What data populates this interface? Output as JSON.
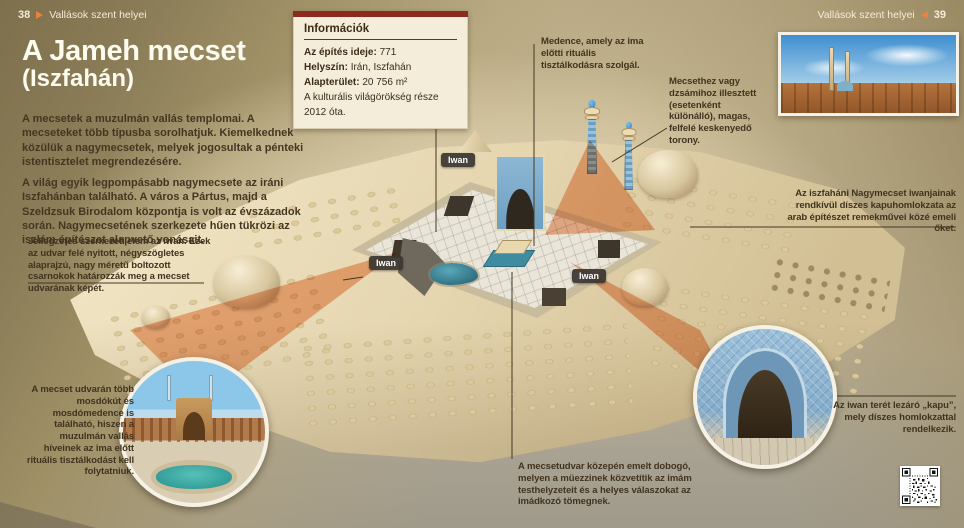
{
  "page": {
    "header_left": {
      "page_number": "38",
      "section": "Vallások szent helyei"
    },
    "header_right": {
      "page_number": "39",
      "section": "Vallások szent helyei"
    },
    "title": "A Jameh mecset",
    "subtitle": "(Iszfahán)",
    "intro_paragraphs": [
      "A mecsetek a muzulmán vallás templomai. A mecseteket több típusba sorolhatjuk. Kiemelkednek közülük a nagymecsetek, melyek jogosultak a pénteki istentisztelet megrendezésére.",
      "A világ egyik legpompásabb nagymecsete az iráni Iszfahánban található. A város a Pártus, majd a Szeldzsuk Birodalom központja is volt az évszázadok során. Nagymecsetének szerkezete hűen tükrözi az iszlám építészet alapvető vonásait."
    ]
  },
  "info_box": {
    "title": "Információk",
    "rows": [
      {
        "label": "Az építés ideje:",
        "value": "771"
      },
      {
        "label": "Helyszín:",
        "value": "Irán, Iszfahán"
      },
      {
        "label": "Alapterület:",
        "value": "20 756 m²"
      }
    ],
    "footnote": "A kulturális világörökség része 2012 óta."
  },
  "callouts": {
    "pool": "Medence, amely az ima előtti rituális tisztálkodásra szolgál.",
    "minaret": "Mecsethez vagy dzsámihoz illesztett (esetenként különálló), magas, felfelé keskenyedő torony.",
    "interior": "Belseje egy egybenyitott tér, berendezés nélkül.",
    "iwan_facade": "Az iszfaháni Nagymecset iwanjainak rendkívül díszes kapuhomlokzata az arab építészet remekművei közé emeli őket.",
    "iwan_structure": "Jellegzetes szerkezeti elem az iwan. Ezek az udvar felé nyitott, négyszögletes alaprajzú, nagy méretű boltozott csarnokok határozzák meg a mecset udvarának képét.",
    "washing": "A mecset udvarán több mosdókút és mosdómedence is található, hiszen a muzulmán vallás híveinek az ima előtt rituális tisztálkodást kell folytatniuk.",
    "platform": "A mecsetudvar közepén emelt dobogó, melyen a müezzinek közvetítik az imám testhelyzeteit és a helyes válaszokat az imádkozó tömegnek.",
    "gate": "Az iwan terét lezáró „kapu”, mely díszes homlokzattal rendelkezik."
  },
  "diagram_labels": {
    "iwan": "Iwan"
  },
  "colors": {
    "accent_orange": "#e8823c",
    "info_box_top_bar": "#8c2a1f",
    "highlight_beam": "#e8702c",
    "sand": "#e9dcb8",
    "pool_blue": "#3e8293"
  }
}
